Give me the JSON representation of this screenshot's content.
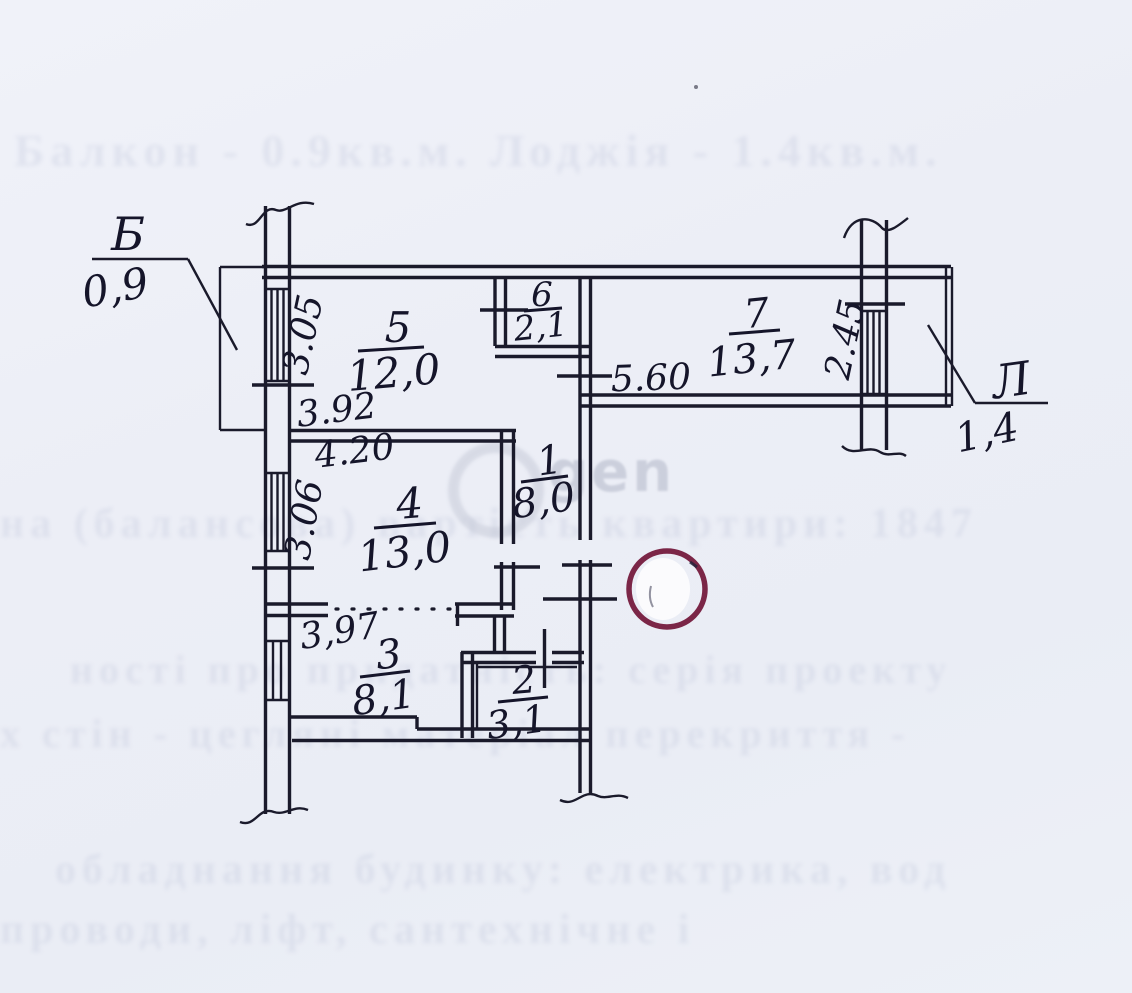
{
  "plan": {
    "balcony": {
      "label": "Б",
      "area": "0,9"
    },
    "loggia": {
      "label": "Л",
      "area": "1,4"
    },
    "rooms": {
      "r1": {
        "number": "1",
        "area": "8,0"
      },
      "r2": {
        "number": "2",
        "area": "3,1"
      },
      "r3": {
        "number": "3",
        "area": "8,1"
      },
      "r4": {
        "number": "4",
        "area": "13,0"
      },
      "r5": {
        "number": "5",
        "area": "12,0"
      },
      "r6": {
        "number": "6",
        "area": "2,1"
      },
      "r7": {
        "number": "7",
        "area": "13,7"
      }
    },
    "dimensions": {
      "d305": "3.05",
      "d392": "3.92",
      "d420": "4.20",
      "d306": "3.06",
      "d397": "3,97",
      "d560": "5.60",
      "d245": "2.45"
    }
  },
  "watermark": {
    "text": "gen"
  },
  "bleed_through": {
    "line1": "Балкон - 0.9кв.м.   Лоджія - 1.4кв.м.",
    "line2": "на (балансова) вартість квартири:      1847",
    "line3": "ності   про   придатність:        серія   проекту",
    "line4": "х стін  -  цегляні            матеріал  перекриття  -",
    "line5": "обладнання    будинку:    електрика,    вод",
    "line6": "проводи,        ліфт,        сантехнічне        і"
  },
  "colors": {
    "paper": "#edeff7",
    "ink": "#1a1a2b",
    "stamp": "#7b2647",
    "watermark_gray": "#b2b7c8"
  }
}
